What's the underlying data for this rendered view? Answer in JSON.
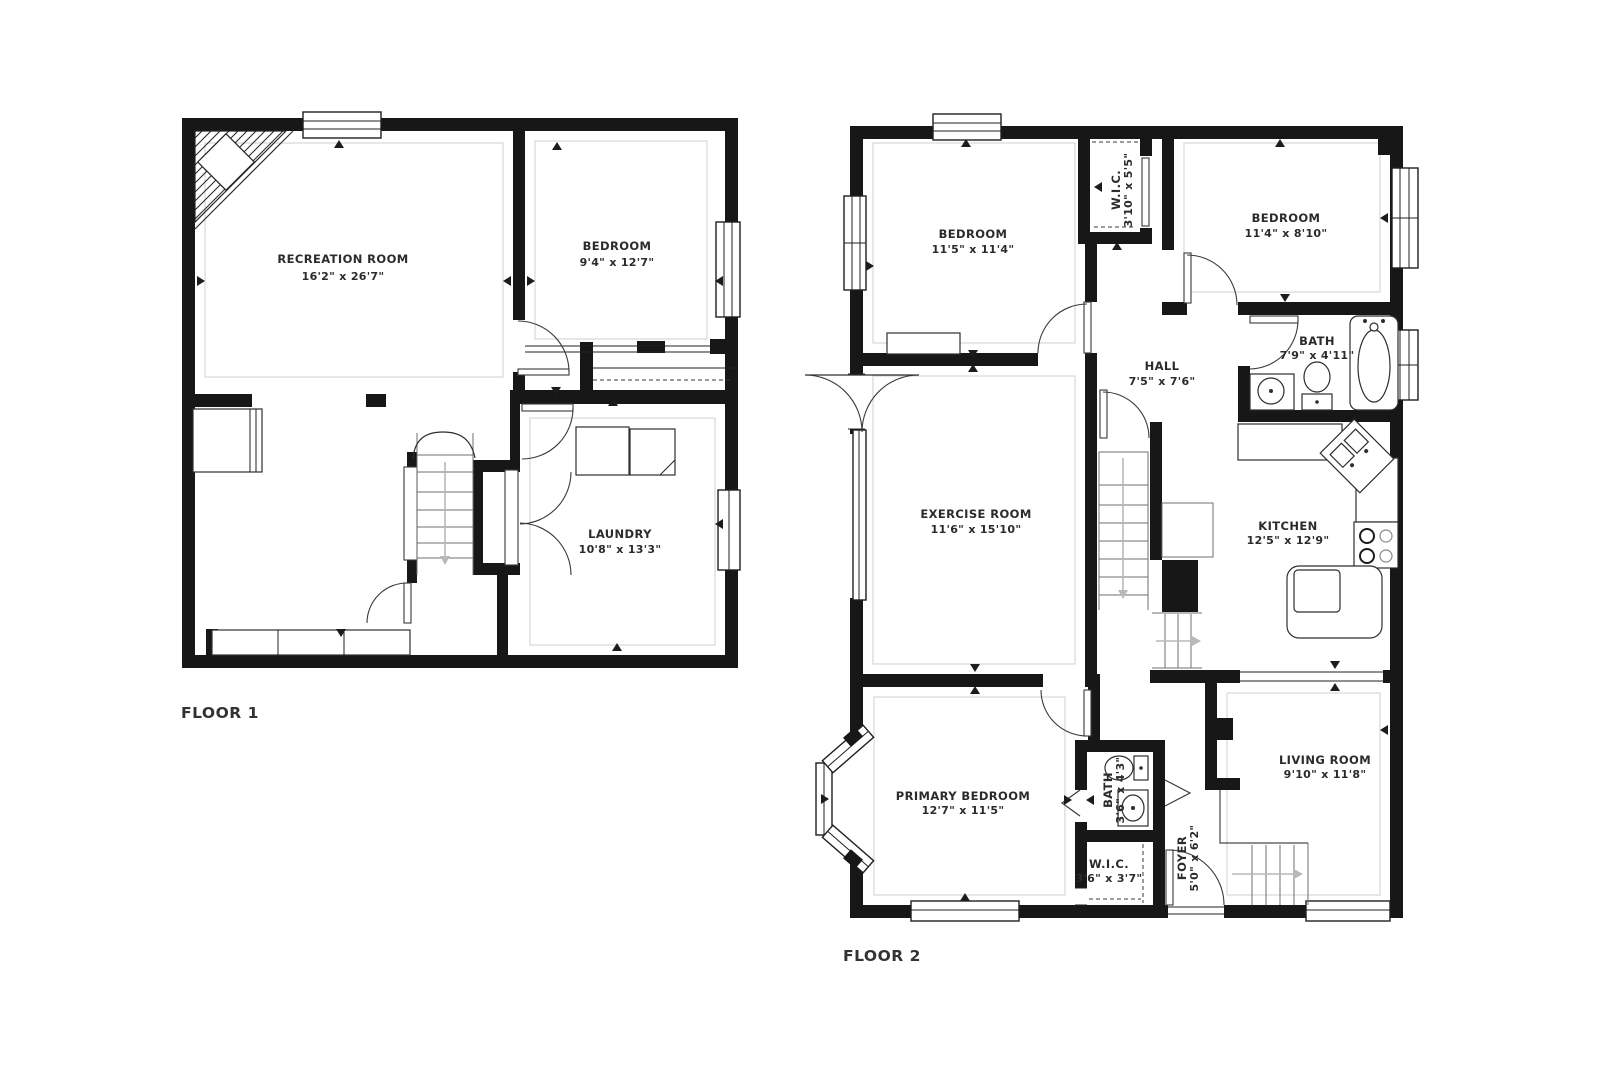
{
  "colors": {
    "background": "#ffffff",
    "walls": "#171717",
    "plan_lines": "#2e2e2e",
    "room_outline": "#cfcfcf",
    "stair_arrow": "#b9b9b9",
    "label_text": "#2b2b2b"
  },
  "floor1": {
    "caption": "FLOOR 1",
    "rooms": [
      {
        "id": "recreation-room",
        "name": "RECREATION ROOM",
        "dims": "16'2\" x 26'7\""
      },
      {
        "id": "bedroom",
        "name": "BEDROOM",
        "dims": "9'4\" x 12'7\""
      },
      {
        "id": "laundry",
        "name": "LAUNDRY",
        "dims": "10'8\" x 13'3\""
      }
    ]
  },
  "floor2": {
    "caption": "FLOOR 2",
    "rooms": [
      {
        "id": "bedroom-left",
        "name": "BEDROOM",
        "dims": "11'5\" x 11'4\""
      },
      {
        "id": "wic-top",
        "name": "W.I.C.",
        "dims": "3'10\" x 5'5\""
      },
      {
        "id": "bedroom-right",
        "name": "BEDROOM",
        "dims": "11'4\" x 8'10\""
      },
      {
        "id": "bath-top",
        "name": "BATH",
        "dims": "7'9\" x 4'11\""
      },
      {
        "id": "hall",
        "name": "HALL",
        "dims": "7'5\" x 7'6\""
      },
      {
        "id": "exercise-room",
        "name": "EXERCISE ROOM",
        "dims": "11'6\" x 15'10\""
      },
      {
        "id": "kitchen",
        "name": "KITCHEN",
        "dims": "12'5\" x 12'9\""
      },
      {
        "id": "primary-bedroom",
        "name": "PRIMARY BEDROOM",
        "dims": "12'7\" x 11'5\""
      },
      {
        "id": "bath-bottom",
        "name": "BATH",
        "dims": "3'6\" x 4'3\""
      },
      {
        "id": "wic-bottom",
        "name": "W.I.C.",
        "dims": "3'6\" x 3'7\""
      },
      {
        "id": "foyer",
        "name": "FOYER",
        "dims": "5'0\" x 6'2\""
      },
      {
        "id": "living-room",
        "name": "LIVING ROOM",
        "dims": "9'10\" x 11'8\""
      }
    ]
  }
}
